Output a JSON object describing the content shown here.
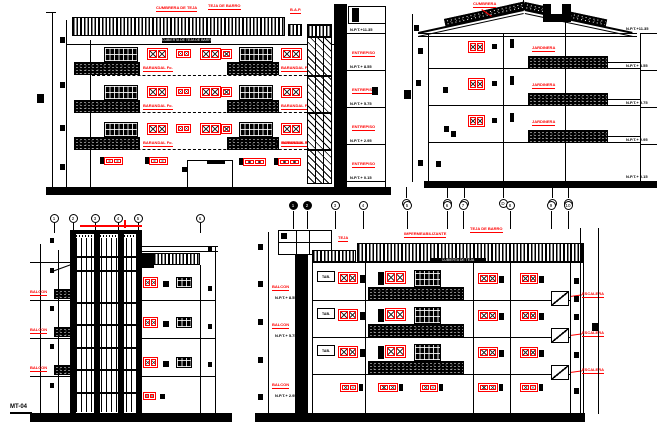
{
  "colors": {
    "ink": "#000000",
    "accent": "#ff0000",
    "paper": "#ffffff"
  },
  "sheet": {
    "title": "MT-04"
  },
  "front": {
    "top_label_1": "CUMBRERA DE TEJA",
    "top_label_2": "TEJA DE BARRO",
    "top_label_3": "B.A.P.",
    "roof_caption": "CUBIERTA DE TEJA DE BARRO",
    "balcony_label": "BARANDAL Fo.",
    "mid_label": "ENTREPISO",
    "levels": [
      "N.P.T.+11.35",
      "N.P.T.+ 8.55",
      "N.P.T.+ 5.75",
      "N.P.T.+ 2.95",
      "N.P.T.+ 0.15"
    ]
  },
  "side": {
    "ridge_label": "CUMBRERA",
    "slab_label": "JARDINERA",
    "levels": [
      "N.P.T.+11.35",
      "N.P.T.+ 8.55",
      "N.P.T.+ 5.75",
      "N.P.T.+ 2.95",
      "N.P.T.+ 0.15"
    ],
    "bubbles": [
      "A",
      "B",
      "C",
      "D",
      "E",
      "F"
    ]
  },
  "rear": {
    "bubbles": [
      "1",
      "2",
      "3",
      "4",
      "5",
      "6"
    ],
    "balcony_label": "BALCON",
    "title": "MT-04"
  },
  "front2": {
    "bubbles": [
      "1",
      "2",
      "3",
      "4",
      "5",
      "6",
      "7",
      "8",
      "9",
      "10"
    ],
    "top_label_1": "TEJA",
    "top_label_2": "IMPERMEABILIZANTE",
    "top_label_3": "TEJA DE BARRO",
    "roof_caption": "CUBIERTA DE TEJA",
    "room_label": "TAB.",
    "stair_label": "ESCALERA",
    "left_label": "BALCON",
    "levels": [
      "N.P.T.+ 8.55",
      "N.P.T.+ 5.75",
      "N.P.T.+ 2.95"
    ]
  }
}
